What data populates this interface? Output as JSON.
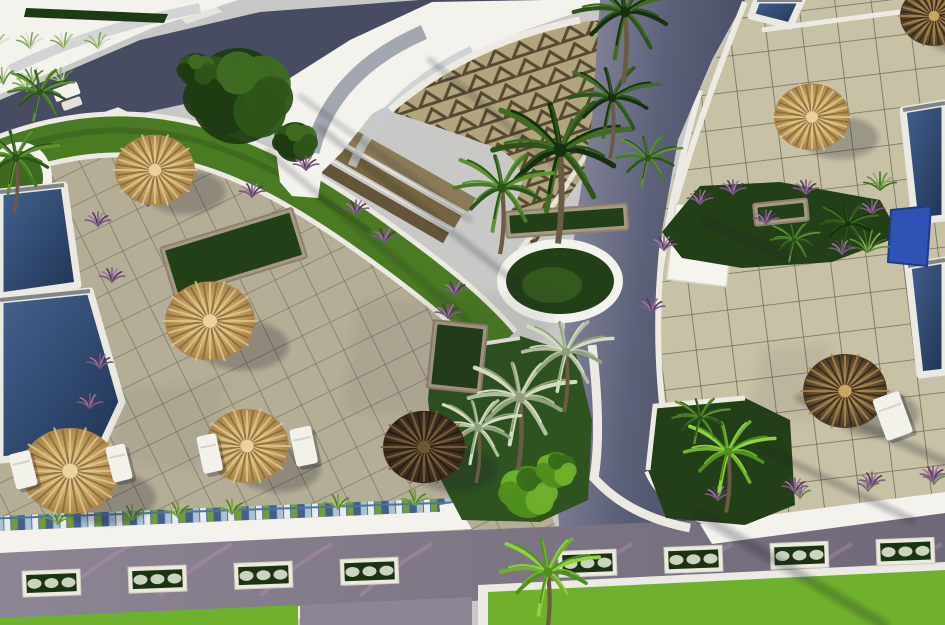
{
  "scene": {
    "kind": "architectural-3d-render",
    "description": "Aerial oblique 3D rendering of a resort courtyard: beige tiled sun terraces with thatch parasols and white loungers, deep-blue swimming pools at left and right edges, a white crescent building with zigzag-tiled roof terrace at top, dark paved access roads, green garden beds with palm trees, planter boxes along a bottom road, bright lawns",
    "visible_text": "none",
    "lighting": "afternoon sun from upper right, long palm shadows toward lower left"
  },
  "palette": {
    "sky_gray": "#c8c8c6",
    "roof_white": "#f3f2ed",
    "wall_white": "#eceae2",
    "hedge_dark": "#1d3a14",
    "road_dark": "#474c62",
    "road_light": "#9693a8",
    "road_bottom": "#8d8593",
    "road_bottom_dark": "#6e6878",
    "tile_left": "#b5ae97",
    "tile_left_grout": "#7e7868",
    "tile_right": "#c7c1a5",
    "tile_right_grout": "#6f6d5c",
    "zigzag_base": "#b2a47c",
    "zigzag_tri": "#564a33",
    "step_browns": [
      "#8a7a58",
      "#76663f",
      "#63543a"
    ],
    "pool_light": "#44628e",
    "pool_deep": "#1f3354",
    "pool_edge": "#eae9e2",
    "aqua_wall": "#2f52b5",
    "grass_band": "#4a7a22",
    "lawn_bright": "#6fb02c",
    "bed_dark": "#233f18",
    "stone": "#a79a84",
    "purple": "#7d5a80",
    "flower_white": "#dfe5d2",
    "shadow": "rgba(25,30,45,0.32)",
    "pink_streak": "rgba(196,150,190,0.35)",
    "mosaic": [
      "#44608a",
      "#a9c2d6",
      "#e9ece9",
      "#6f9e3a"
    ]
  },
  "ground": {
    "left_terrace": {
      "points": "0,148 118,108 228,162 352,240 452,322 524,432 560,540 0,580",
      "tile_size": 31,
      "angle": -26
    },
    "right_terrace": {
      "points": "745,0 945,0 945,540 690,540 664,460 652,340 660,225 700,90",
      "tile_size": 36,
      "angle": -7
    }
  },
  "roads": {
    "top_left": "0,100 140,40 260,12 420,0 560,0 470,45 360,70 240,92 120,118 0,148",
    "vertical": "600,0 745,0 712,60 678,140 662,230 656,330 662,420 676,478 700,525 560,540 556,480 560,400 566,310 576,220 592,120",
    "bottom": "0,550 945,510 945,580 0,622",
    "bottom_patch": "300,605 472,597 472,625 300,625",
    "crosswalk": "178,14 214,4 222,12 186,24"
  },
  "bottom_strip": {
    "mosaic": "0,516 458,498 458,511 0,531",
    "walkway_left": "0,531 460,511 472,529 0,553",
    "walkway_right": "700,524 945,492 945,513 712,544",
    "curb_left": "0,620 300,606 300,619 0,633",
    "lawn_left": "0,618 298,605 298,625 0,625",
    "lawn_right_border": "478,585 945,562 945,625 478,625",
    "lawn_right": "488,592 945,570 945,625 488,625"
  },
  "planter_row": {
    "xs": [
      22,
      128,
      234,
      340,
      558,
      664,
      770,
      876
    ],
    "w": 58,
    "h": 26,
    "rot": -2.2
  },
  "pools": [
    {
      "name": "left-upper",
      "points": "0,192 64,185 78,285 0,296"
    },
    {
      "name": "left-lower",
      "points": "0,300 90,291 122,402 100,449 0,460"
    },
    {
      "name": "right-upper",
      "points": "903,110 945,103 945,218 915,221"
    },
    {
      "name": "right-lower",
      "points": "908,266 945,260 945,372 920,375"
    },
    {
      "name": "top-small",
      "points": "757,0 802,0 790,26 751,16"
    }
  ],
  "water_feature": {
    "points": "891,210 931,206 927,266 888,262"
  },
  "umbrellas": [
    {
      "cx": 155,
      "cy": 170,
      "r": 40,
      "style": "tan"
    },
    {
      "cx": 210,
      "cy": 321,
      "r": 45,
      "style": "tan"
    },
    {
      "cx": 70,
      "cy": 471,
      "r": 49,
      "style": "tan"
    },
    {
      "cx": 247,
      "cy": 446,
      "r": 42,
      "style": "tan"
    },
    {
      "cx": 424,
      "cy": 447,
      "r": 41,
      "style": "brown"
    },
    {
      "cx": 812,
      "cy": 117,
      "r": 38,
      "style": "tan"
    },
    {
      "cx": 845,
      "cy": 391,
      "r": 42,
      "style": "brown_tan"
    },
    {
      "cx": 934,
      "cy": 16,
      "r": 34,
      "style": "brown_tan"
    }
  ],
  "umbrella_styles": {
    "tan": {
      "outer": "#a9854b",
      "mid": "#c9a763",
      "inner": "#ead2a0",
      "ray": "#8a6a38",
      "ray2": "#e0c58c"
    },
    "brown": {
      "outer": "#35281a",
      "mid": "#4a3826",
      "inner": "#6e5636",
      "ray": "#241a10",
      "ray2": "#7c6240"
    },
    "brown_tan": {
      "outer": "#4a3a26",
      "mid": "#7a6038",
      "inner": "#c9a763",
      "ray": "#33271a",
      "ray2": "#a8854e"
    }
  },
  "loungers": [
    {
      "x": 8,
      "y": 455,
      "w": 22,
      "h": 36,
      "rot": -14
    },
    {
      "x": 105,
      "y": 448,
      "w": 20,
      "h": 36,
      "rot": -14
    },
    {
      "x": 196,
      "y": 437,
      "w": 20,
      "h": 38,
      "rot": -12
    },
    {
      "x": 289,
      "y": 430,
      "w": 22,
      "h": 38,
      "rot": -12
    },
    {
      "x": 872,
      "y": 400,
      "w": 28,
      "h": 44,
      "rot": -20
    }
  ],
  "bench": {
    "x": 52,
    "y": 90
  },
  "sign": {
    "x": 676,
    "y": 204,
    "w": 60,
    "h": 76,
    "rot": 7
  },
  "round_planter": {
    "cx": 560,
    "cy": 281,
    "rx": 63,
    "ry": 42,
    "rim": 9
  },
  "stone_planters": [
    {
      "x": 505,
      "y": 212,
      "w": 122,
      "h": 26,
      "rot": -4,
      "content": "grass"
    },
    {
      "x": 753,
      "y": 204,
      "w": 54,
      "h": 22,
      "rot": -6,
      "content": "grass"
    },
    {
      "x": 160,
      "y": 248,
      "w": 138,
      "h": 52,
      "rot": -17,
      "content": "fern"
    },
    {
      "x": 434,
      "y": 320,
      "w": 54,
      "h": 68,
      "rot": 6,
      "content": "fern"
    },
    {
      "x": -8,
      "y": 294,
      "w": 72,
      "h": 22,
      "rot": -3,
      "content": "turf"
    }
  ],
  "beds": {
    "center": "432,350 520,336 576,354 592,420 588,500 540,522 462,520 436,470 428,400",
    "right_upper": "662,232 700,186 780,182 880,200 900,236 832,262 742,268 682,258",
    "right_lower": "655,406 745,398 790,420 795,505 745,525 666,518 648,470"
  },
  "palm_trees": [
    {
      "x": 560,
      "y": 150,
      "s": 1.7,
      "type": "dark"
    },
    {
      "x": 612,
      "y": 98,
      "s": 1.1,
      "type": "dark"
    },
    {
      "x": 502,
      "y": 188,
      "s": 1.2,
      "type": "mid"
    },
    {
      "x": 648,
      "y": 158,
      "s": 0.8,
      "type": "mid"
    },
    {
      "x": 625,
      "y": 12,
      "s": 1.3,
      "type": "dark"
    },
    {
      "x": 520,
      "y": 398,
      "s": 1.3,
      "type": "silver"
    },
    {
      "x": 566,
      "y": 352,
      "s": 1.1,
      "type": "silver"
    },
    {
      "x": 478,
      "y": 428,
      "s": 1.0,
      "type": "silver"
    },
    {
      "x": 848,
      "y": 224,
      "s": 0.7,
      "type": "dark"
    },
    {
      "x": 794,
      "y": 240,
      "s": 0.6,
      "type": "mid"
    },
    {
      "x": 728,
      "y": 452,
      "s": 1.1,
      "type": "bright"
    },
    {
      "x": 700,
      "y": 418,
      "s": 0.7,
      "type": "mid"
    },
    {
      "x": 548,
      "y": 572,
      "s": 1.2,
      "type": "bright"
    },
    {
      "x": 16,
      "y": 158,
      "s": 1.0,
      "type": "mid"
    },
    {
      "x": 40,
      "y": 92,
      "s": 0.8,
      "type": "mid"
    }
  ],
  "palm_styles": {
    "dark": [
      "#16300f",
      "#2c5318",
      "#3f6b22"
    ],
    "mid": [
      "#2c5318",
      "#477a26",
      "#5e9232"
    ],
    "bright": [
      "#4f8f1e",
      "#6fb02c",
      "#8fd13f"
    ],
    "silver": [
      "#8fa07c",
      "#b2bf9e",
      "#d2dcc0"
    ]
  },
  "bushes": [
    {
      "x": 238,
      "y": 96,
      "r": 48,
      "type": "dark"
    },
    {
      "x": 295,
      "y": 142,
      "r": 20,
      "type": "dark"
    },
    {
      "x": 196,
      "y": 70,
      "r": 17,
      "type": "dark"
    },
    {
      "x": 528,
      "y": 492,
      "r": 26,
      "type": "midbright"
    },
    {
      "x": 556,
      "y": 470,
      "r": 18,
      "type": "midbright"
    }
  ],
  "purple_tufts": [
    [
      98,
      226
    ],
    [
      148,
      206
    ],
    [
      252,
      197
    ],
    [
      306,
      170
    ],
    [
      356,
      214
    ],
    [
      385,
      242
    ],
    [
      112,
      282
    ],
    [
      100,
      368
    ],
    [
      90,
      408
    ],
    [
      448,
      318
    ],
    [
      455,
      295
    ],
    [
      664,
      250
    ],
    [
      700,
      204
    ],
    [
      733,
      194
    ],
    [
      766,
      224
    ],
    [
      806,
      194
    ],
    [
      842,
      254
    ],
    [
      872,
      214
    ],
    [
      718,
      500
    ],
    [
      795,
      492
    ],
    [
      872,
      486
    ],
    [
      933,
      480
    ],
    [
      652,
      312
    ]
  ],
  "grass_tufts_mosaic": [
    [
      58,
      524
    ],
    [
      132,
      520
    ],
    [
      178,
      517
    ],
    [
      232,
      514
    ],
    [
      338,
      509
    ],
    [
      415,
      505
    ]
  ],
  "walk_plants_right": [
    [
      728,
      506
    ],
    [
      800,
      498
    ],
    [
      868,
      491
    ],
    [
      934,
      484
    ]
  ],
  "shadow_streaks": [
    {
      "x1": 945,
      "y1": 462,
      "x2": 800,
      "y2": 398,
      "w": 9
    },
    {
      "x1": 912,
      "y1": 520,
      "x2": 762,
      "y2": 448,
      "w": 7
    },
    {
      "x1": 884,
      "y1": 625,
      "x2": 700,
      "y2": 515,
      "w": 10
    },
    {
      "x1": 790,
      "y1": 258,
      "x2": 706,
      "y2": 222,
      "w": 6
    },
    {
      "x1": 320,
      "y1": 128,
      "x2": 520,
      "y2": 286,
      "w": 6
    },
    {
      "x1": 268,
      "y1": 152,
      "x2": 468,
      "y2": 320,
      "w": 5
    },
    {
      "x1": 300,
      "y1": 96,
      "x2": 470,
      "y2": 220,
      "w": 4
    },
    {
      "x1": 430,
      "y1": 60,
      "x2": 560,
      "y2": 170,
      "w": 5
    }
  ],
  "big_shadows": [
    {
      "points": "360,300 560,292 520,420 340,412",
      "opacity": 0.2
    },
    {
      "points": "120,390 230,380 200,470 110,462",
      "opacity": 0.16
    },
    {
      "points": "760,350 830,344 816,420 752,414",
      "opacity": 0.2
    }
  ],
  "pink_streak_xs": [
    60,
    160,
    260,
    360,
    560,
    660,
    780,
    870
  ]
}
